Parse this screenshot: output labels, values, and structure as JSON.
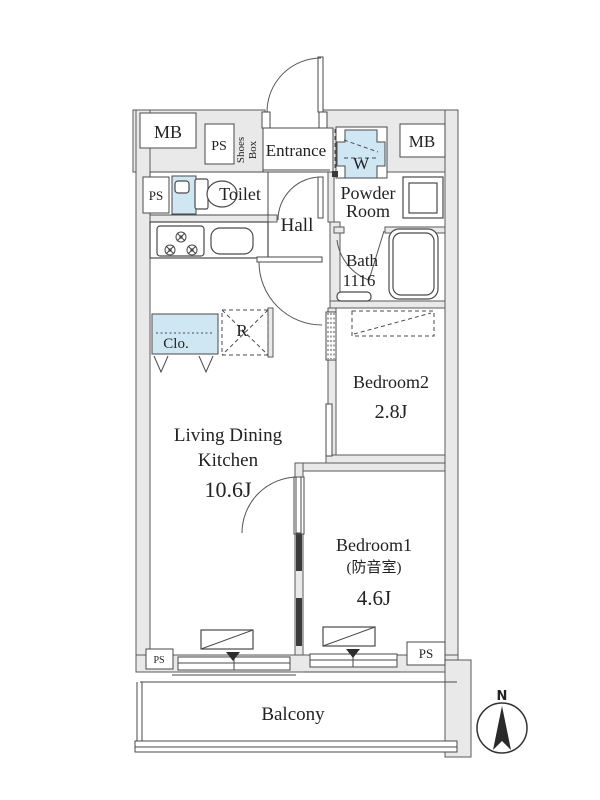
{
  "plan": {
    "rooms": {
      "ldk": {
        "name_line1": "Living Dining",
        "name_line2": "Kitchen",
        "size": "10.6J"
      },
      "bedroom1": {
        "name": "Bedroom1",
        "note": "(防音室)",
        "size": "4.6J"
      },
      "bedroom2": {
        "name": "Bedroom2",
        "size": "2.8J"
      },
      "entrance": {
        "name": "Entrance"
      },
      "hall": {
        "name": "Hall"
      },
      "toilet": {
        "name": "Toilet"
      },
      "powder_room": {
        "name_line1": "Powder",
        "name_line2": "Room"
      },
      "bath": {
        "name": "Bath",
        "size": "1116"
      },
      "balcony": {
        "name": "Balcony"
      }
    },
    "fixtures": {
      "shoes_box_line1": "Shoes",
      "shoes_box_line2": "Box",
      "washer": "W",
      "closet": "Clo.",
      "fridge": "R"
    },
    "utilities": {
      "mb_left": "MB",
      "mb_right": "MB",
      "ps_top": "PS",
      "ps_mid_left": "PS",
      "ps_bottom_left": "PS",
      "ps_bottom_right": "PS"
    },
    "compass": {
      "north": "N"
    },
    "colors": {
      "wall_fill": "#e9e9e9",
      "line": "#4a4a4a",
      "fixture_blue": "#cfe7f3",
      "soundproof_wall": "#3a3a3a",
      "text": "#222222"
    }
  }
}
